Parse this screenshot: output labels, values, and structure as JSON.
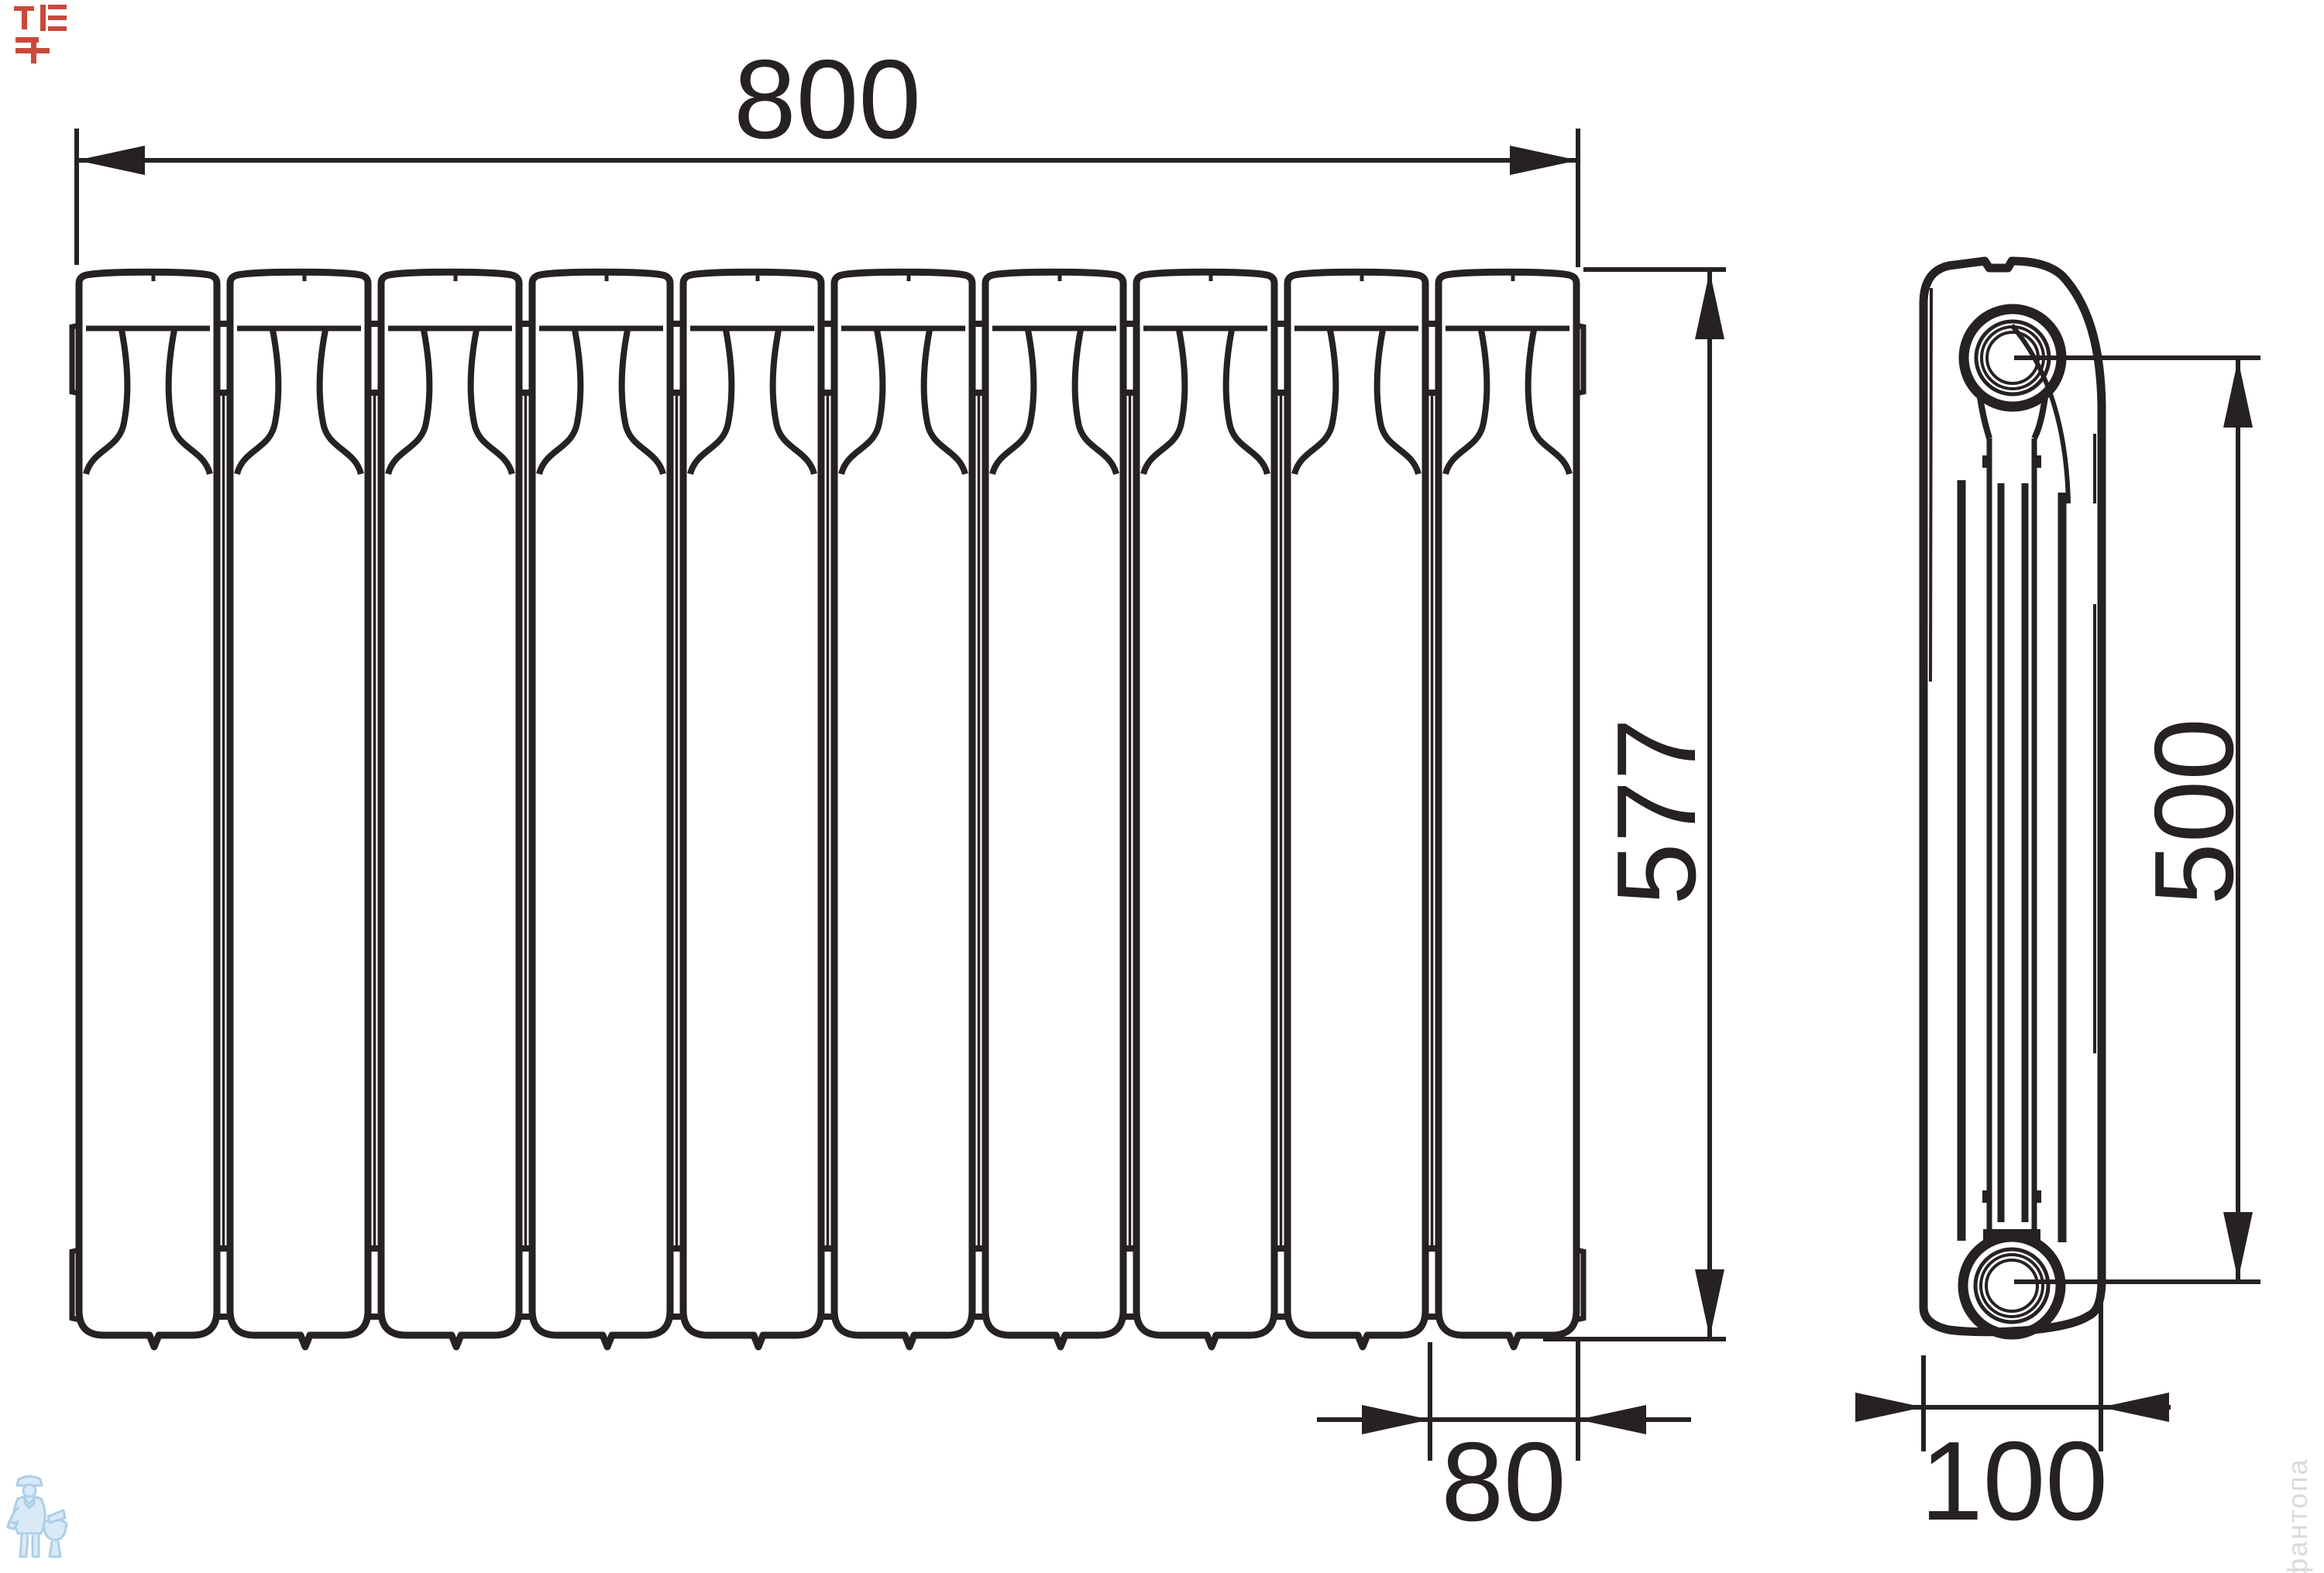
{
  "meta": {
    "type": "technical drawing",
    "subject": "Sectional bimetallic radiator — front view and side view with overall dimensions"
  },
  "front_view": {
    "name": "front view",
    "sections": "10"
  },
  "side_view": {
    "name": "side view"
  },
  "dimensions": {
    "width": "800",
    "height": "577",
    "section_width": "80",
    "axis_spacing": "500",
    "depth": "100"
  },
  "watermarks": {
    "vertical_text": "фантопа",
    "corner_mark": "red logo glyphs",
    "logo": "plumber with toilet"
  },
  "colors": {
    "line": "#262122",
    "corner_red": "#c43a2a",
    "watermark_blue": "#aecfe8",
    "watermark_blue_fill": "#d9e9f6",
    "watermark_gray": "#d4d4d4",
    "background": "#ffffff"
  }
}
